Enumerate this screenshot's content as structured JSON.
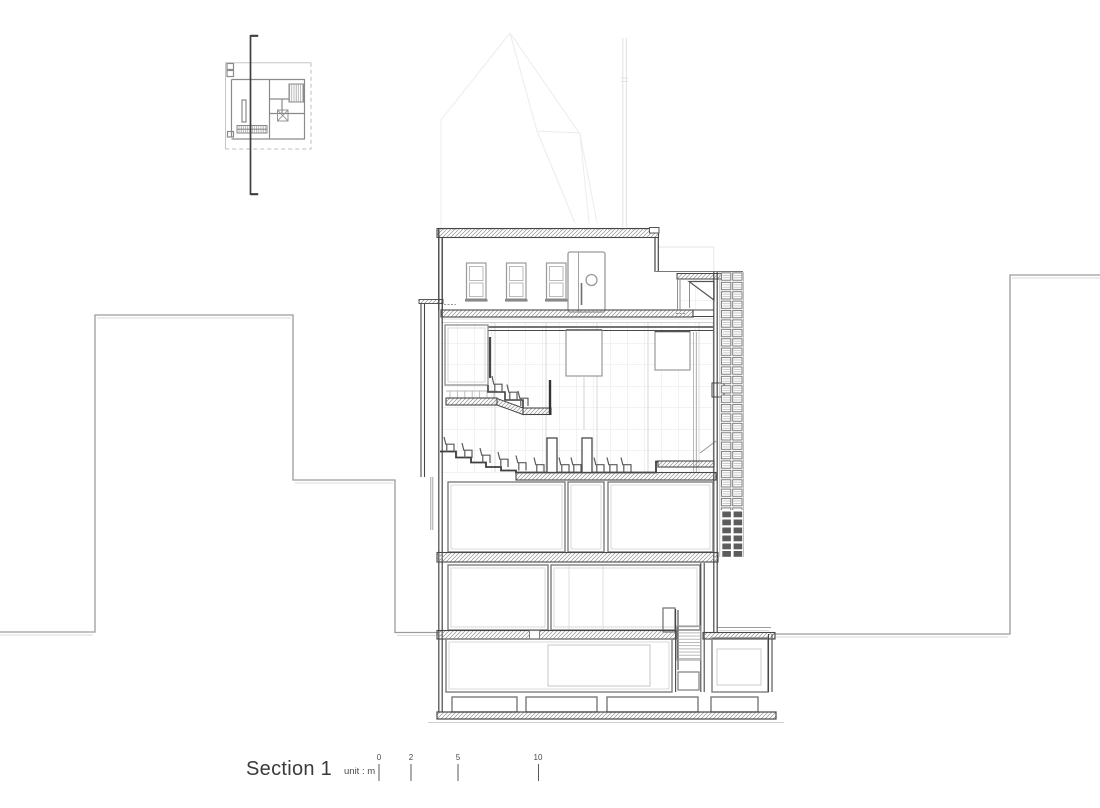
{
  "title": {
    "label": "Section 1"
  },
  "scale_bar": {
    "unit_label": "unit : m",
    "tick_labels": [
      "0",
      "2",
      "5",
      "10"
    ]
  },
  "colors": {
    "background": "#ffffff",
    "cut_line": "#474747",
    "wall_line": "#7d7d7d",
    "inner_line": "#d6d6d6",
    "neighbor_line": "#9c9c9c",
    "grid_line": "#e4e4e4",
    "faint_line": "#ececec",
    "text": "#3a3a3a"
  }
}
